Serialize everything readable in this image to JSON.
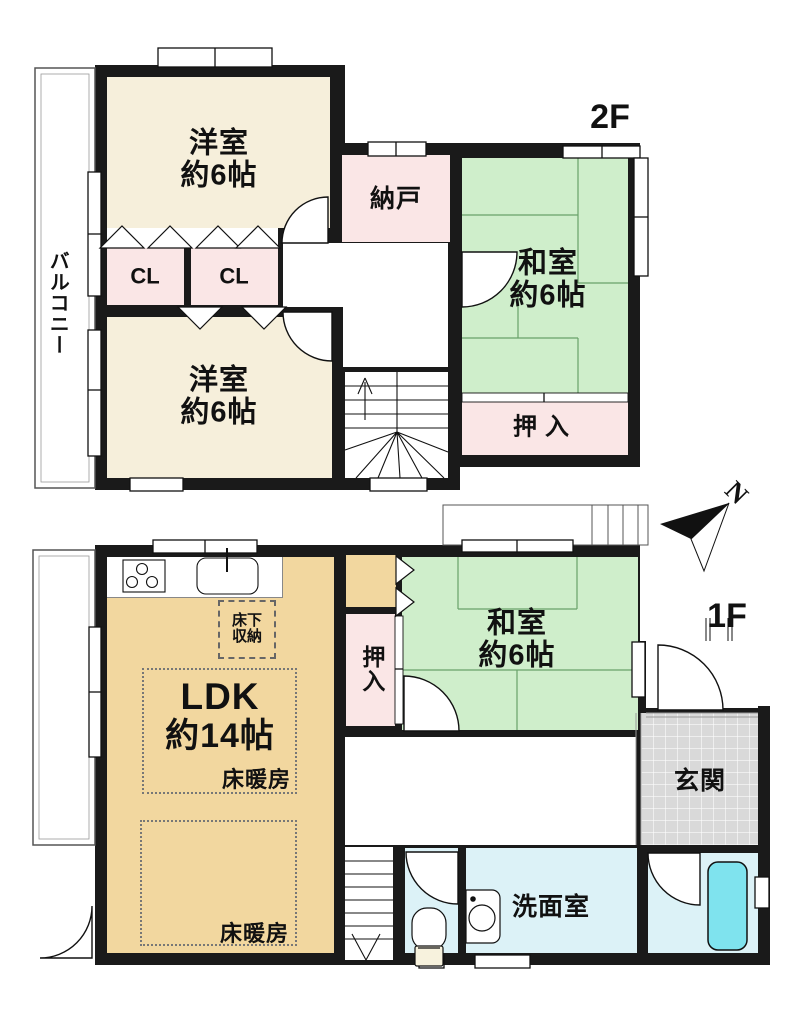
{
  "plan_title": "floor-plan",
  "floor2": {
    "label": "2F",
    "balcony": "バルコニー",
    "yoshitsu_top": {
      "name": "洋室",
      "size": "約6帖"
    },
    "nando": "納戸",
    "washitsu": {
      "name": "和室",
      "size": "約6帖"
    },
    "cl_left": "CL",
    "cl_right": "CL",
    "yoshitsu_bottom": {
      "name": "洋室",
      "size": "約6帖"
    },
    "oshiire": "押入"
  },
  "floor1": {
    "label": "1F",
    "ldk": {
      "name": "LDK",
      "size": "約14帖"
    },
    "yukashita": {
      "line1": "床下",
      "line2": "収納"
    },
    "yukadanbo_upper": "床暖房",
    "yukadanbo_lower": "床暖房",
    "oshiire": "押入",
    "washitsu": {
      "name": "和室",
      "size": "約6帖"
    },
    "genkan": "玄関",
    "senmenshitsu": "洗面室"
  },
  "compass": {
    "label": "N"
  },
  "colors": {
    "wall": "#1a1a1a",
    "western_room": "#f6efdb",
    "japanese_room": "#cfeecb",
    "closet_pink": "#fae6e6",
    "ldk_tan": "#f2d79f",
    "wet_area_blue": "#dcf2f7",
    "bathtub_cyan": "#7fe3ee",
    "entrance_gray": "#d9d9d9"
  }
}
